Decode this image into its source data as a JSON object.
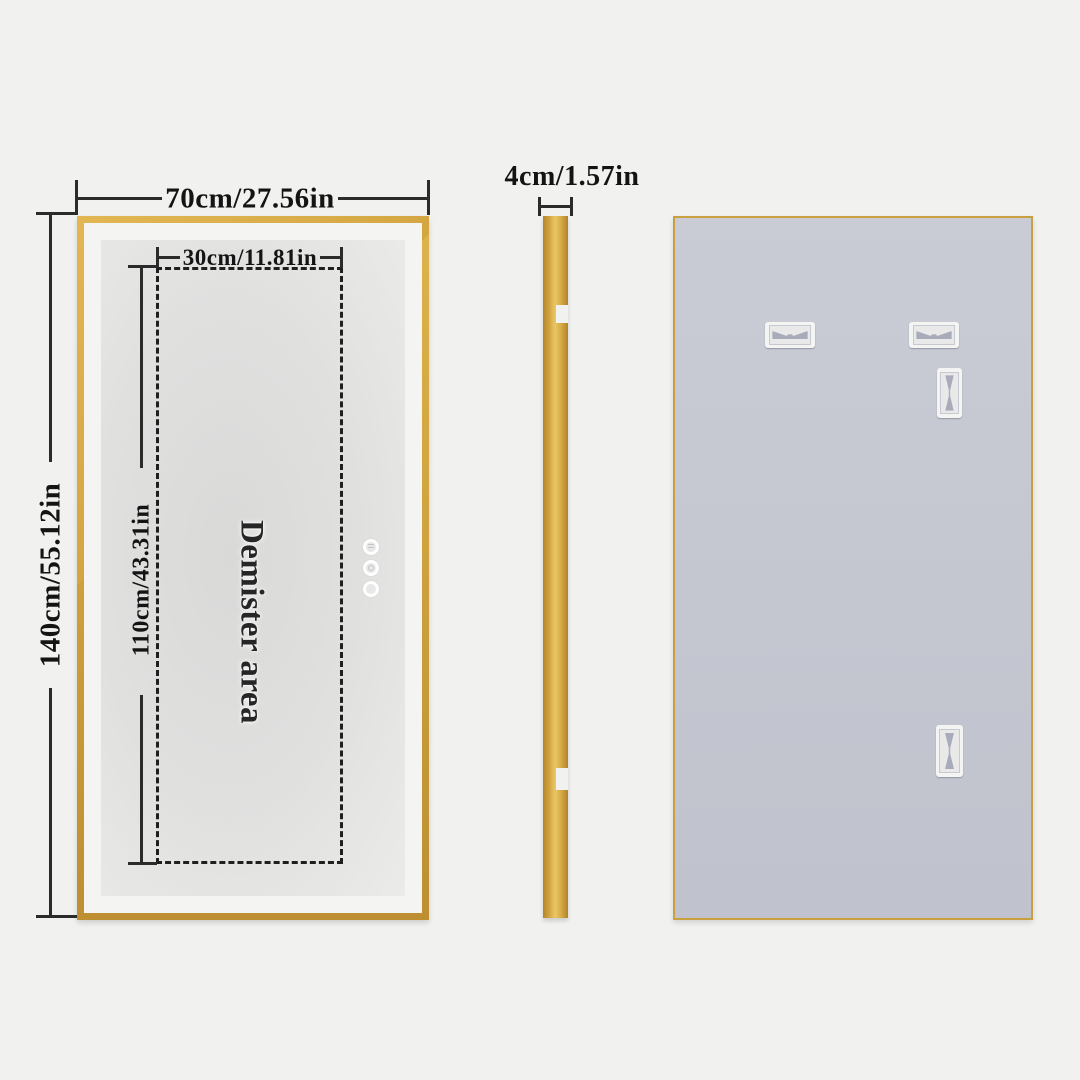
{
  "front_view": {
    "width_label": "70cm/27.56in",
    "height_label": "140cm/55.12in",
    "demister_width_label": "30cm/11.81in",
    "demister_height_label": "110cm/43.31in",
    "demister_area_label": "Demister area",
    "touch_button_count": 3
  },
  "side_view": {
    "thickness_label": "4cm/1.57in"
  },
  "back_view": {
    "horizontal_bracket_count": 2,
    "vertical_bracket_count": 2
  },
  "colors": {
    "background": "#f1f1ef",
    "gold_frame": "#d2a441",
    "mirror_surface": "#e0e0df",
    "back_panel": "#c6c8d2",
    "dimension_line": "#2b2b2b"
  }
}
